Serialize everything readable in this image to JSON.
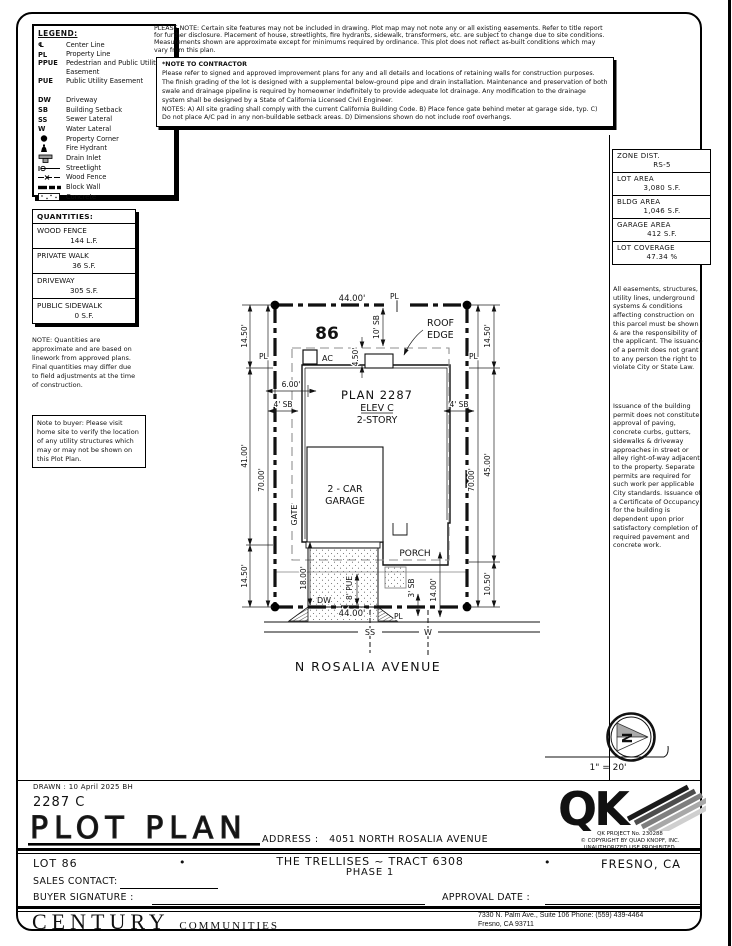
{
  "legend": {
    "title": "LEGEND:",
    "items": [
      {
        "abbr": "℄",
        "label": "Center Line"
      },
      {
        "abbr": "PL",
        "label": "Property Line"
      },
      {
        "abbr": "PPUE",
        "label": "Pedestrian and Public Utility Easement"
      },
      {
        "abbr": "PUE",
        "label": "Public Utility Easement"
      },
      {
        "abbr": "DW",
        "label": "Driveway"
      },
      {
        "abbr": "SB",
        "label": "Building Setback"
      },
      {
        "abbr": "SS",
        "label": "Sewer Lateral"
      },
      {
        "abbr": "W",
        "label": "Water Lateral"
      },
      {
        "label": "Property Corner"
      },
      {
        "label": "Fire Hydrant"
      },
      {
        "label": "Drain Inlet"
      },
      {
        "label": "Streetlight"
      },
      {
        "label": "Wood Fence"
      },
      {
        "label": "Block Wall"
      },
      {
        "label": "Concrete"
      }
    ]
  },
  "header_notes": {
    "please_note": "PLEASE NOTE:  Certain site features may not be included in drawing.  Plot map may not note any or all existing easements. Refer to title report for further disclosure.  Placement of house, streetlights, fire hydrants, sidewalk, transformers, etc. are subject to change due to site conditions.  Measurements shown are approximate except for minimums required by ordinance.  This plot does not reflect as-built conditions which may vary from this plan.",
    "contractor_title": "*NOTE TO CONTRACTOR",
    "contractor_p1": "Please refer to signed and approved improvement plans for any and all details and locations of retaining walls for construction purposes.",
    "contractor_p2": "The finish grading of the lot is designed with a supplemental below-ground pipe and drain installation.  Maintenance and preservation of both swale and drainage pipeline is required by homeowner indefinitely to provide adequate lot drainage.  Any modification to the drainage system shall be designed by a State of California Licensed Civil Engineer.",
    "contractor_p3": "NOTES:  A) All site grading shall comply with the current California Building Code.  B) Place fence gate behind meter at garage side, typ.  C) Do not place A/C pad in any non-buildable setback areas.  D) Dimensions shown do not include roof overhangs."
  },
  "zone_table": {
    "rows": [
      {
        "label": "ZONE DIST.",
        "value": "RS-5"
      },
      {
        "label": "LOT AREA",
        "value": "3,080 S.F."
      },
      {
        "label": "BLDG AREA",
        "value": "1,046 S.F."
      },
      {
        "label": "GARAGE AREA",
        "value": "412 S.F."
      },
      {
        "label": "LOT COVERAGE",
        "value": "47.34 %"
      }
    ]
  },
  "right_notes": {
    "p1": "All easements, structures, utility lines, underground systems & conditions affecting construction on this parcel must be shown & are the responsibility of the applicant. The issuance of a permit does not grant to any person the right to violate City or State Law.",
    "p2": "Issuance of the building permit does not constitute approval of paving, concrete curbs, gutters, sidewalks & driveway approaches in street or alley right-of-way adjacent to the property. Separate permits are required for such work per applicable City standards. Issuance of a Certificate of Occupancy for the building is dependent upon prior satisfactory completion of required pavement and concrete work."
  },
  "quantities": {
    "title": "QUANTITIES:",
    "rows": [
      {
        "label": "WOOD FENCE",
        "value": "144 L.F."
      },
      {
        "label": "PRIVATE WALK",
        "value": "36 S.F."
      },
      {
        "label": "DRIVEWAY",
        "value": "305 S.F."
      },
      {
        "label": "PUBLIC SIDEWALK",
        "value": "0 S.F."
      }
    ],
    "note": "NOTE: Quantities are approximate and are based on linework from approved plans.  Final quantities may differ due to field adjustments at the time of construction.",
    "buyer_note": "Note to buyer: Please visit home site to verify the location of any utility structures which may or may not be shown on this Plot Plan."
  },
  "plot": {
    "lot_number": "86",
    "street_name": "N ROSALIA AVENUE",
    "plan_line1": "PLAN 2287",
    "plan_line2": "ELEV C",
    "plan_line3": "2-STORY",
    "garage_line1": "2 - CAR",
    "garage_line2": "GARAGE",
    "porch": "PORCH",
    "gate": "GATE",
    "ac": "AC",
    "dw": "DW",
    "roof_line1": "ROOF",
    "roof_line2": "EDGE",
    "ss": "SS",
    "w": "W",
    "pl": "PL",
    "dims": {
      "top_width": "44.00'",
      "bottom_width": "44.00'",
      "left_top": "14.50'",
      "left_mid": "41.00'",
      "left_bottom": "14.50'",
      "left_depth": "70.00'",
      "right_top": "14.50'",
      "right_mid": "45.00'",
      "right_bottom": "10.50'",
      "right_depth": "70.00'",
      "sb_top": "10' SB",
      "sb_left": "4' SB",
      "sb_right": "4' SB",
      "sb_bottom": "3' SB",
      "roof_offset": "4.50'",
      "ac_offset": "6.00'",
      "drive_depth": "18.00'",
      "pue": "8' PUE",
      "porch_offset": "14.00'"
    }
  },
  "compass": {
    "n": "N",
    "scale": "1\" = 20'"
  },
  "title_block": {
    "drawn": "DRAWN : 10 April 2025   BH",
    "plan_number": "2287 C",
    "title": "PLOT PLAN",
    "address_label": "ADDRESS :",
    "address": "4051 NORTH ROSALIA AVENUE",
    "lot": "LOT 86",
    "bullet": "•",
    "community": "THE TRELLISES ~ TRACT 6308",
    "phase": "PHASE 1",
    "city": "FRESNO, CA",
    "sales_contact": "SALES CONTACT:",
    "buyer_signature": "BUYER SIGNATURE :",
    "approval_date": "APPROVAL DATE :"
  },
  "qk": {
    "logo": "QK",
    "project": "QK PROJECT No. 230288",
    "copyright": "©  COPYRIGHT BY QUAD KNOPF, INC.",
    "rights": "UNAUTHORIZED USE PROHIBITED."
  },
  "builder": {
    "name": "CENTURY",
    "suffix": "COMMUNITIES",
    "address": "7330 N. Palm Ave., Suite 106   Phone: (559) 439-4464",
    "city": "Fresno, CA  93711"
  }
}
